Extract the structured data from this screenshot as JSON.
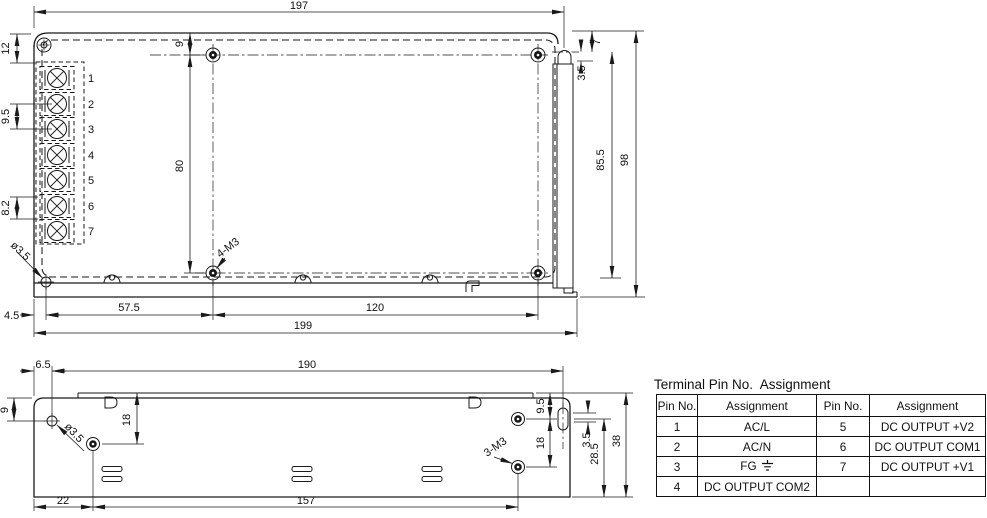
{
  "top_view": {
    "dims": {
      "w197": "197",
      "h12": "12",
      "p95": "9.5",
      "p82": "8.2",
      "o9": "9",
      "h80": "80",
      "dia": "ø3.5",
      "m3": "4-M3",
      "o45": "4.5",
      "w575": "57.5",
      "w120": "120",
      "w199": "199",
      "o7": "7",
      "s35": "3.5",
      "h855": "85.5",
      "h98": "98"
    },
    "terminal_numbers": [
      "1",
      "2",
      "3",
      "4",
      "5",
      "6",
      "7"
    ]
  },
  "side_view": {
    "dims": {
      "o65": "6.5",
      "w190": "190",
      "o9": "9",
      "d18l": "18",
      "dia": "ø3.5",
      "o22": "22",
      "w157": "157",
      "o95": "9.5",
      "d18r": "18",
      "m3": "3-M3",
      "s35": "3.5",
      "h285": "28.5",
      "h38": "38"
    }
  },
  "pin_table": {
    "title": "Terminal Pin No.  Assignment",
    "headers": [
      "Pin No.",
      "Assignment",
      "Pin No.",
      "Assignment"
    ],
    "rows": [
      {
        "pin_l": "1",
        "assign_l": "AC/L",
        "pin_r": "5",
        "assign_r": "DC OUTPUT +V2"
      },
      {
        "pin_l": "2",
        "assign_l": "AC/N",
        "pin_r": "6",
        "assign_r": "DC OUTPUT COM1"
      },
      {
        "pin_l": "3",
        "assign_l": "FG",
        "pin_r": "7",
        "assign_r": "DC OUTPUT +V1"
      },
      {
        "pin_l": "4",
        "assign_l": "DC OUTPUT COM2",
        "pin_r": "",
        "assign_r": ""
      }
    ],
    "icons": {
      "ground": "earth-ground-icon"
    }
  },
  "colors": {
    "line": "#1a1a1a",
    "background": "#ffffff"
  }
}
